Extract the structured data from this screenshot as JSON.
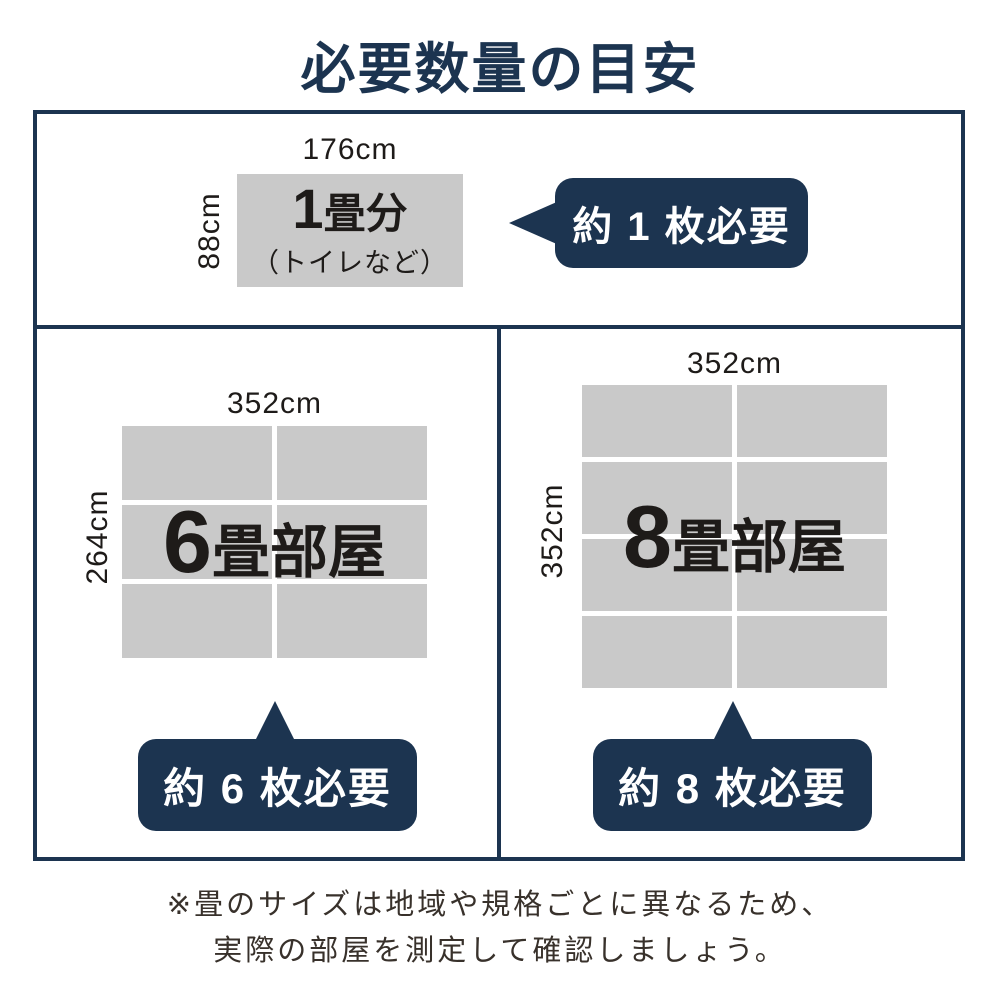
{
  "title": "必要数量の目安",
  "colors": {
    "navy": "#1c3450",
    "gray": "#c9c9c9",
    "text": "#1e1b19",
    "note_text": "#38312b"
  },
  "single": {
    "width_label": "176cm",
    "height_label": "88cm",
    "number": "1",
    "suffix": "畳分",
    "note": "（トイレなど）",
    "bubble": "約 1 枚必要"
  },
  "room6": {
    "width_label": "352cm",
    "height_label": "264cm",
    "number": "6",
    "suffix": "畳部屋",
    "grid": {
      "rows": 3,
      "cols": 2
    },
    "bubble": "約 6 枚必要"
  },
  "room8": {
    "width_label": "352cm",
    "height_label": "352cm",
    "number": "8",
    "suffix": "畳部屋",
    "grid": {
      "rows": 4,
      "cols": 2
    },
    "bubble": "約 8 枚必要"
  },
  "footer": {
    "line1": "※畳のサイズは地域や規格ごとに異なるため、",
    "line2": "実際の部屋を測定して確認しましょう。"
  }
}
